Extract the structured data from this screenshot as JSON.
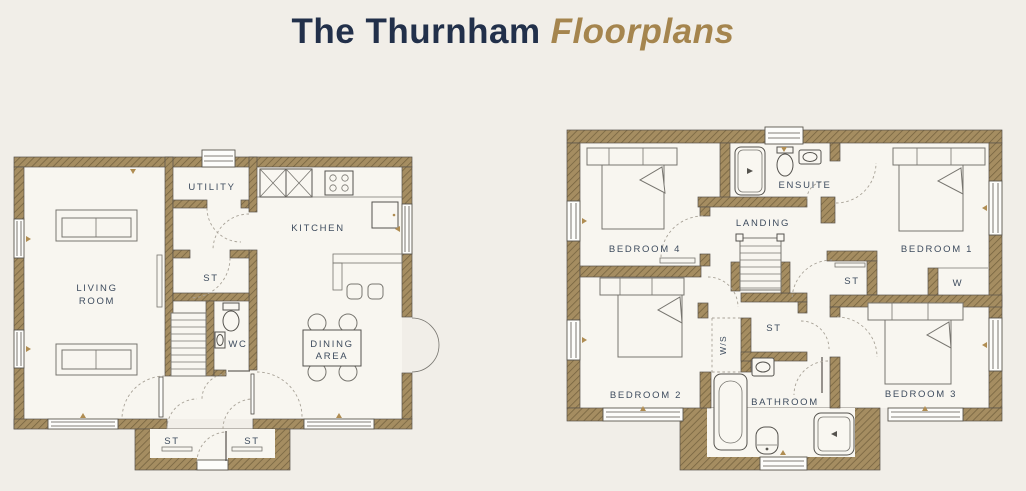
{
  "title": {
    "prefix": "The Thurnham",
    "emphasis": "Floorplans"
  },
  "colors": {
    "background": "#f1eee8",
    "wall_fill": "#a58d61",
    "wall_hatch": "#74623f",
    "title_navy": "#22304a",
    "title_gold": "#a5854e",
    "label_text": "#3e4c5e",
    "marker_gold": "#b08d52"
  },
  "ground_floor": {
    "rooms": {
      "living_1": "LIVING",
      "living_2": "ROOM",
      "utility": "UTILITY",
      "kitchen": "KITCHEN",
      "store": "ST",
      "wc": "WC",
      "dining_1": "DINING",
      "dining_2": "AREA",
      "store_porch_left": "ST",
      "store_porch_right": "ST"
    }
  },
  "first_floor": {
    "rooms": {
      "bedroom4": "BEDROOM 4",
      "ensuite": "ENSUITE",
      "landing": "LANDING",
      "bedroom1": "BEDROOM 1",
      "store_landing": "ST",
      "wardrobe": "W",
      "bedroom2": "BEDROOM 2",
      "wardrobe_space": "W/S",
      "store_center": "ST",
      "bathroom": "BATHROOM",
      "bedroom3": "BEDROOM 3"
    }
  }
}
